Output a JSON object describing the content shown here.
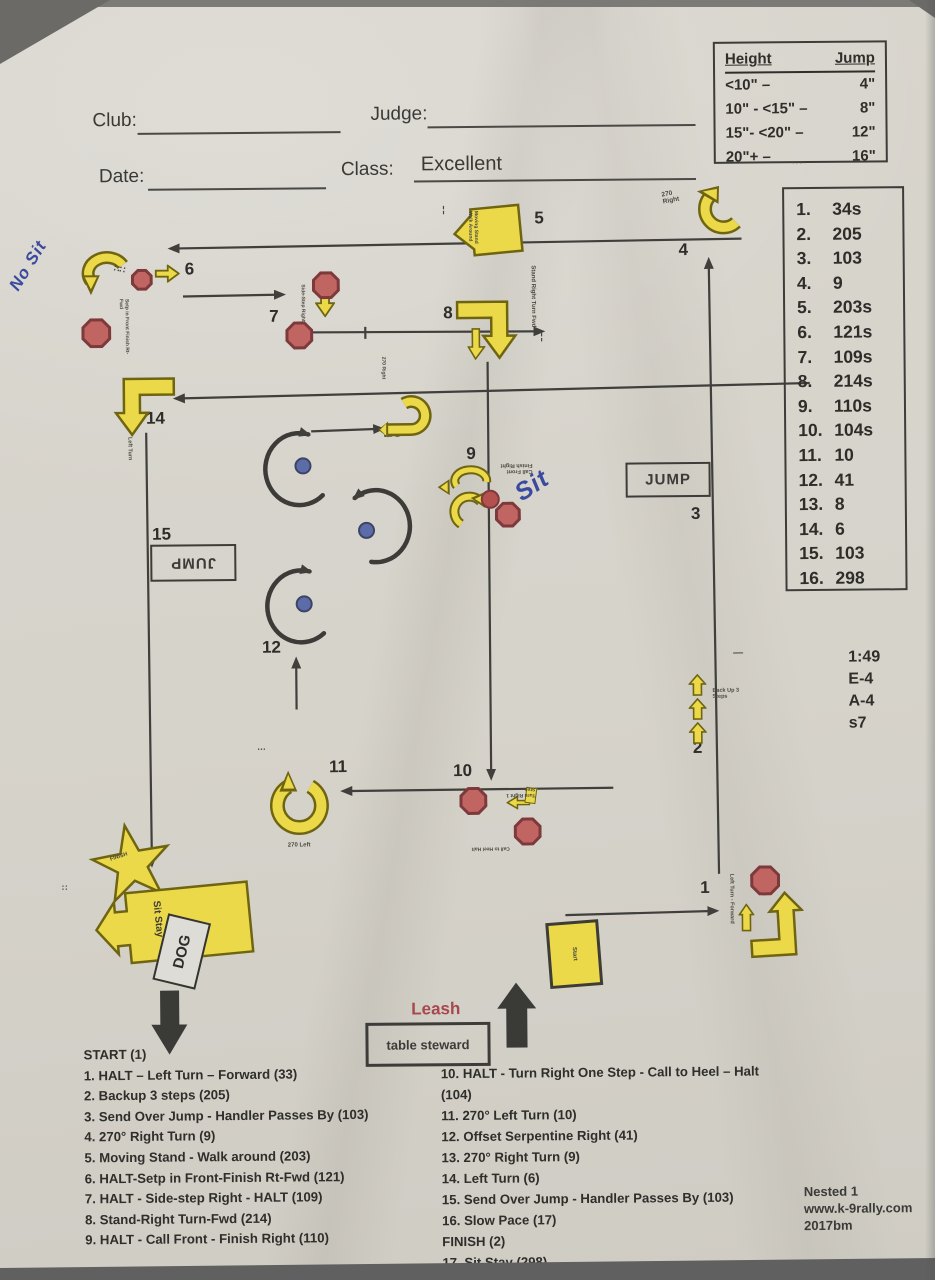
{
  "header": {
    "club_label": "Club:",
    "judge_label": "Judge:",
    "date_label": "Date:",
    "class_label": "Class:",
    "class_value": "Excellent"
  },
  "jump_table": {
    "col_height": "Height",
    "col_jump": "Jump",
    "rows": [
      {
        "h": "<10\" –",
        "j": "4\""
      },
      {
        "h": "10\" - <15\" –",
        "j": "8\""
      },
      {
        "h": "15\"- <20\" –",
        "j": "12\""
      },
      {
        "h": "20\"+ –",
        "j": "16\""
      }
    ]
  },
  "right_list": {
    "items": [
      {
        "num": "1.",
        "val": "34s"
      },
      {
        "num": "2.",
        "val": "205"
      },
      {
        "num": "3.",
        "val": "103"
      },
      {
        "num": "4.",
        "val": "9"
      },
      {
        "num": "5.",
        "val": "203s"
      },
      {
        "num": "6.",
        "val": "121s"
      },
      {
        "num": "7.",
        "val": "109s"
      },
      {
        "num": "8.",
        "val": "214s"
      },
      {
        "num": "9.",
        "val": "110s"
      },
      {
        "num": "10.",
        "val": "104s"
      },
      {
        "num": "11.",
        "val": "10"
      },
      {
        "num": "12.",
        "val": "41"
      },
      {
        "num": "13.",
        "val": "8"
      },
      {
        "num": "14.",
        "val": "6"
      },
      {
        "num": "15.",
        "val": "103"
      },
      {
        "num": "16.",
        "val": "298"
      }
    ]
  },
  "info_block": {
    "lines": [
      "1:49",
      "E-4",
      "A-4",
      "s7"
    ]
  },
  "footer_left": {
    "title": "START (1)",
    "items": [
      "1. HALT – Left Turn – Forward (33)",
      "2. Backup 3 steps (205)",
      "3. Send Over Jump - Handler Passes By (103)",
      "4. 270° Right Turn (9)",
      "5. Moving Stand - Walk around (203)",
      "6. HALT-Setp in Front-Finish Rt-Fwd (121)",
      "7. HALT - Side-step Right - HALT (109)",
      "8. Stand-Right Turn-Fwd (214)",
      "9. HALT - Call Front - Finish Right (110)"
    ]
  },
  "footer_right": {
    "items": [
      "10. HALT - Turn Right One Step - Call to Heel – Halt (104)",
      "11. 270° Left Turn (10)",
      "12. Offset Serpentine Right (41)",
      "13. 270° Right Turn (9)",
      "14. Left Turn  (6)",
      "15. Send Over Jump - Handler Passes By (103)",
      "16. Slow Pace (17)",
      "FINISH (2)",
      "17. Sit Stay (298)"
    ]
  },
  "credits": {
    "lines": [
      "Nested 1",
      "www.k-9rally.com",
      "2017bm"
    ]
  },
  "course": {
    "numbers": {
      "s1": "1",
      "s2": "2",
      "s3": "3",
      "s4": "4",
      "s5": "5",
      "s6": "6",
      "s7": "7",
      "s8": "8",
      "s9": "9",
      "s10": "10",
      "s11": "11",
      "s12": "12",
      "s13": "13",
      "s14": "14",
      "s15": "15",
      "s16": "16"
    },
    "jump_right_label": "JUMP",
    "jump_left_label": "JUMP",
    "leash_label": "Leash",
    "table_steward_label": "table steward",
    "dog_label": "DOG",
    "start_sign_label": "Start",
    "finish_star_label": "FINISH",
    "handwriting": {
      "no_sit": "No Sit",
      "sit": "Sit"
    },
    "sign_texts": {
      "s1": "Left Turn - Forward",
      "s2": "Back Up 3 Steps",
      "s4": "270 Right",
      "s5": "Moving Stand Walk Around",
      "s6": "Setp in Front Finish Rt-Fwd",
      "s7": "Side-Step Right",
      "s8": "Stand Right Turn Fwd",
      "s9": "Call Front Finish Right",
      "s10a": "Turn Right 1 Step",
      "s10b": "Call to Heel Halt",
      "s11": "270 Left",
      "s13": "270 Right",
      "s14": "Left Turn",
      "s16": "Sit Stay"
    }
  },
  "colors": {
    "paper": "#d6d3cb",
    "ink": "#3c3b37",
    "sign_yellow": "#ecd94a",
    "sign_outline": "#6f6511",
    "halt_red": "#c06562",
    "post_blue": "#5c6ca8",
    "handwriting_blue": "#3a4a9e",
    "leash_red": "#a8474e"
  }
}
